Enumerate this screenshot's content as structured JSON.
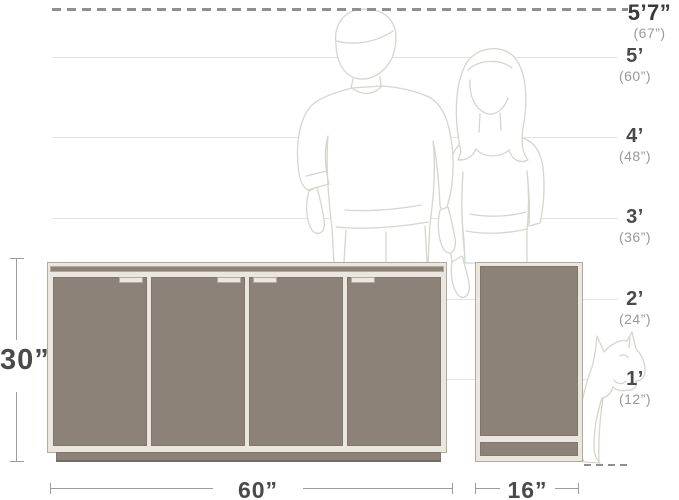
{
  "height_scale": {
    "entries": [
      {
        "feet": "5’7”",
        "inches": "(67”)"
      },
      {
        "feet": "5’",
        "inches": "(60”)"
      },
      {
        "feet": "4’",
        "inches": "(48”)"
      },
      {
        "feet": "3’",
        "inches": "(36”)"
      },
      {
        "feet": "2’",
        "inches": "(24”)"
      },
      {
        "feet": "1’",
        "inches": "(12”)"
      }
    ]
  },
  "dimensions": {
    "height": "30”",
    "width": "60”",
    "depth": "16”"
  },
  "figures": {
    "man": "man-outline-silhouette",
    "woman": "woman-outline-silhouette",
    "dog": "french-bulldog-outline-silhouette"
  },
  "colors": {
    "taupe": "#8d8277",
    "panel_light": "#ece7de",
    "frame_line": "#b3aa9c",
    "door_line": "#80776a",
    "grid_line": "#e4e2df",
    "dash_line": "#8f8f8f",
    "dim_line": "#9c9c9c",
    "text_dark": "#4a4a4a",
    "text_black": "#3a3a3a",
    "text_gray": "#9b9998",
    "figure_line": "#d8d4ce"
  }
}
